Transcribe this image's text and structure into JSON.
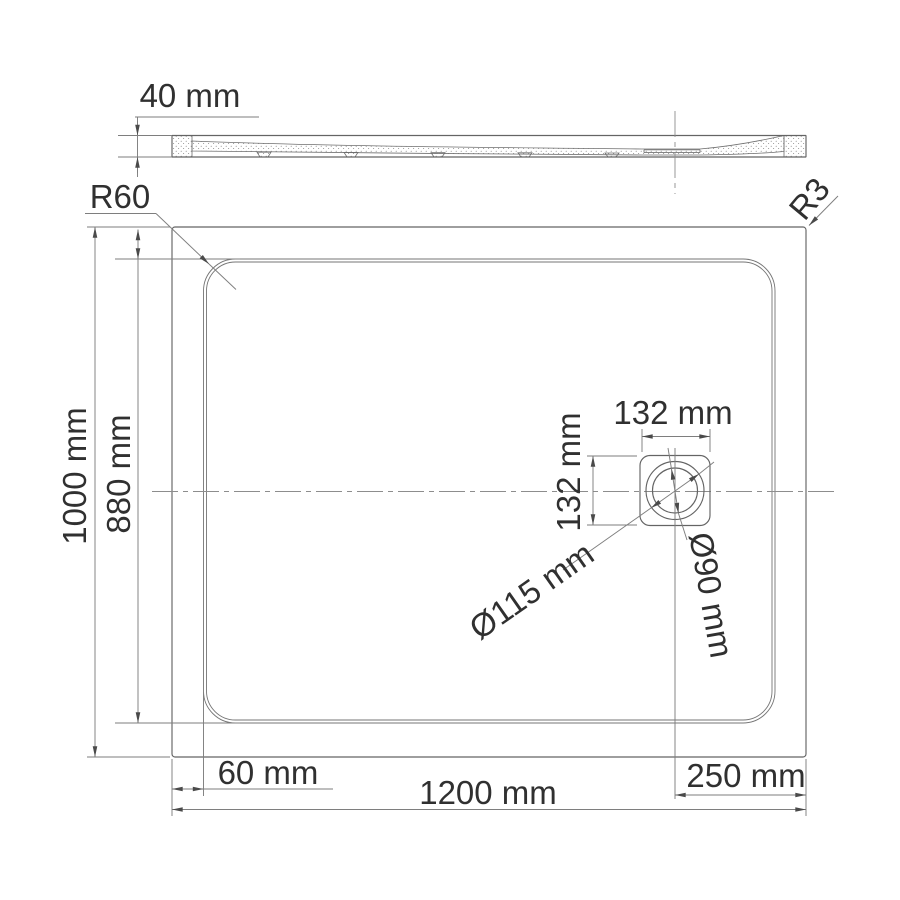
{
  "drawing": {
    "title": "Shower tray technical drawing (plan view and side section)",
    "labels": {
      "thickness": "40 mm",
      "inner_corner_radius": "R60",
      "outer_corner_radius": "R3",
      "overall_depth": "1000 mm",
      "basin_depth": "880 mm",
      "drain_box_width": "132 mm",
      "drain_box_height": "132 mm",
      "drain_outer_diameter": "Ø115 mm",
      "drain_inner_diameter": "Ø90 mm",
      "edge_offset": "60 mm",
      "overall_width": "1200 mm",
      "drain_offset_from_right": "250 mm"
    },
    "values_mm": {
      "thickness": 40,
      "overall_width": 1200,
      "overall_depth": 1000,
      "basin_depth": 880,
      "inner_corner_radius": 60,
      "outer_corner_radius": 3,
      "drain_box_size": 132,
      "drain_outer_diameter": 115,
      "drain_inner_diameter": 90,
      "edge_offset": 60,
      "drain_offset_from_right": 250
    },
    "colors": {
      "background": "#ffffff",
      "lines": "#646464",
      "dimension_lines": "#7e7e7e",
      "text": "#303030"
    }
  }
}
